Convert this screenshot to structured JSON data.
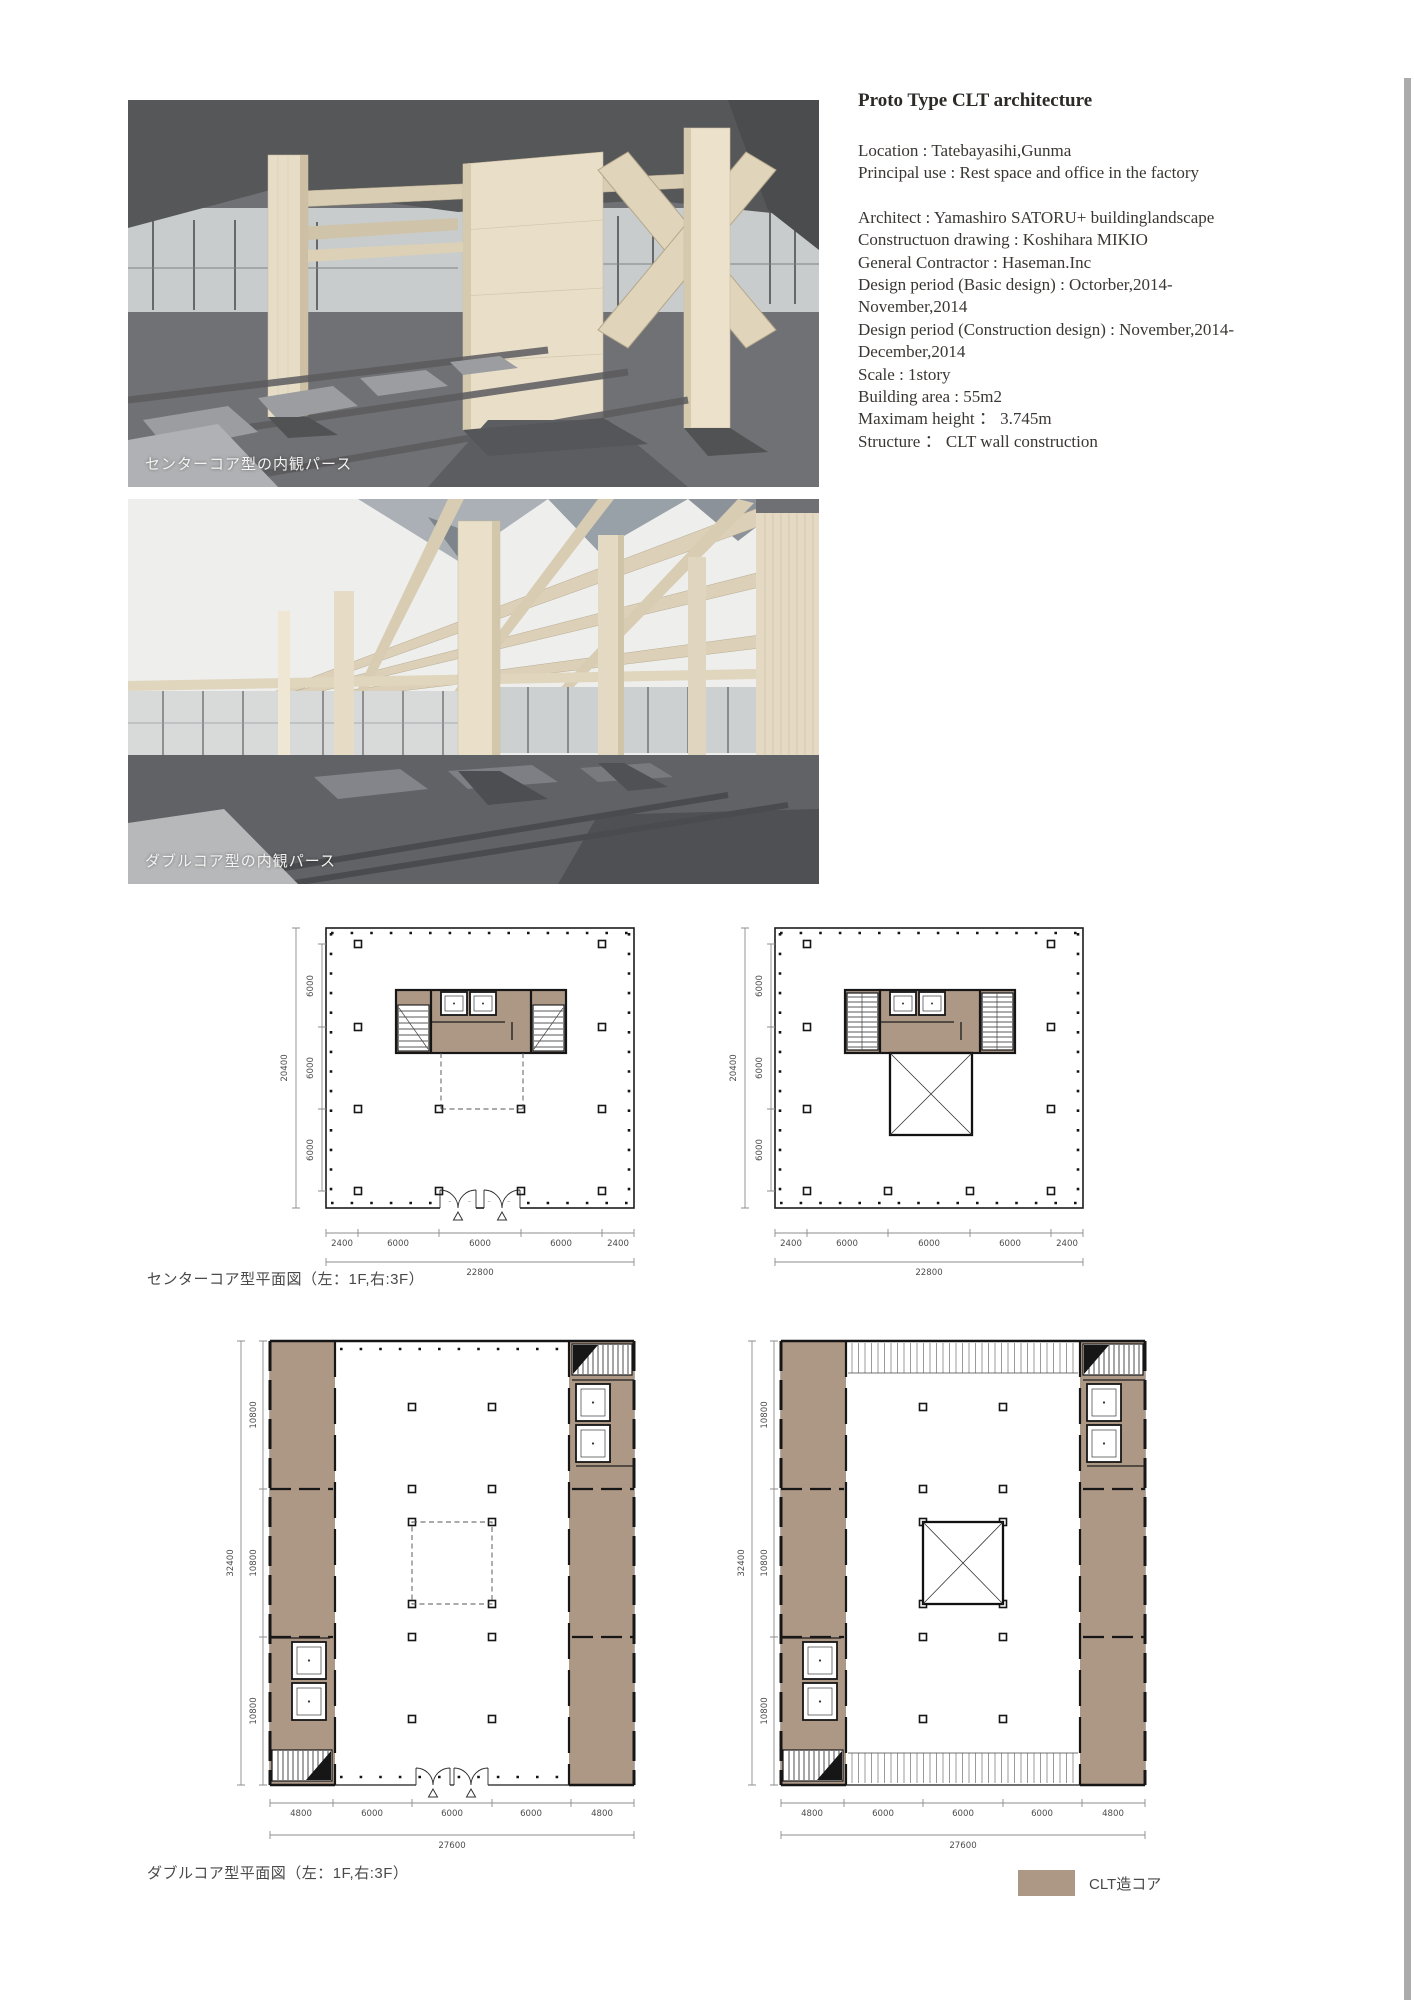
{
  "info": {
    "title": "Proto Type CLT architecture",
    "lines": [
      "Location : Tatebayasihi,Gunma",
      "Principal use : Rest space and office in the factory",
      "Architect : Yamashiro SATORU+ buildinglandscape",
      "Constructuon drawing : Koshihara MIKIO",
      "General Contractor : Haseman.Inc",
      "Design period (Basic design) : Octorber,2014-",
      "November,2014",
      "Design period (Construction design) : November,2014-",
      "December,2014",
      "Scale : 1story",
      "Building area : 55m2",
      "Maximam height ： 3.745m",
      "Structure ： CLT wall construction"
    ]
  },
  "renders": [
    {
      "caption": "センターコア型の内観パース"
    },
    {
      "caption": "ダブルコア型の内観パース"
    }
  ],
  "plans": {
    "center_core": {
      "caption": "センターコア型平面図（左：1F,右:3F）",
      "left_total": "20400",
      "left_segments": [
        "6000",
        "6000",
        "6000"
      ],
      "bottom_segments": [
        "2400",
        "6000",
        "6000",
        "6000",
        "2400"
      ],
      "bottom_total": "22800"
    },
    "double_core": {
      "caption": "ダブルコア型平面図（左：1F,右:3F）",
      "left_total": "32400",
      "left_segments": [
        "10800",
        "10800",
        "10800"
      ],
      "bottom_segments": [
        "4800",
        "6000",
        "6000",
        "6000",
        "4800"
      ],
      "bottom_total": "27600"
    },
    "legend": {
      "label": "CLT造コア",
      "color": "#ad9785"
    }
  },
  "colors": {
    "core_brown": "#ad9785",
    "render_ceiling": "#565759",
    "render_wood": "#e9dfc9",
    "render_floor": "#707174"
  }
}
